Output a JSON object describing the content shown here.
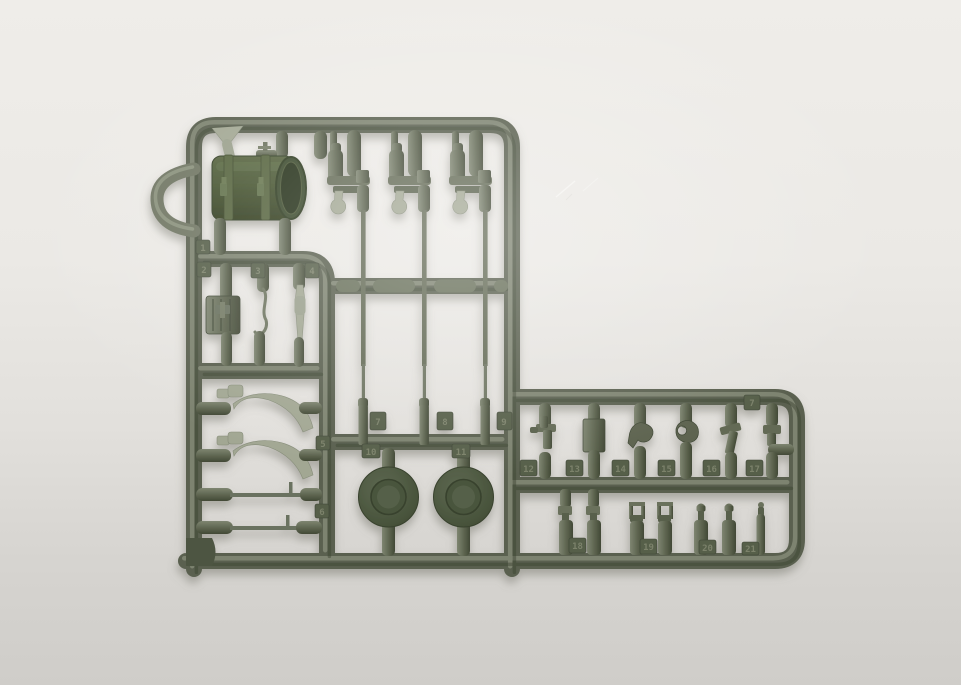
{
  "photo": {
    "subject": "Olive-green injection-molded plastic model kit sprue (parts runner) photographed on a neutral light-gray background",
    "shape": "L-shaped runner frame with a right-hand extension",
    "background_top": "#EFEDE9",
    "background_bottom": "#CFCDC9",
    "plastic_base": "#5A6150",
    "plastic_highlight": "#8B927D",
    "plastic_shadow": "#39402F",
    "drum_green": "#45532F",
    "light_part_tone": "#A2A793",
    "scratch_marks": "faint scratches on backdrop upper right"
  },
  "tags": {
    "t1": "1",
    "t2": "2",
    "t3": "3",
    "t4": "4",
    "t5": "5",
    "t6": "6",
    "t7": "7",
    "t8": "8",
    "t9": "9",
    "t10": "10",
    "t11": "11",
    "ext_corner": "7",
    "t12": "12",
    "t13": "13",
    "t14": "14",
    "t15": "15",
    "t16": "16",
    "t17": "17",
    "t18": "18",
    "t19": "19",
    "t20": "20",
    "t21": "21"
  },
  "parts_inventory": [
    {
      "name": "fuel drum with strap bands",
      "count": 1
    },
    {
      "name": "y-shaped bracket",
      "count": 1
    },
    {
      "name": "filler cap fitting",
      "count": 1
    },
    {
      "name": "stowage box",
      "count": 1
    },
    {
      "name": "tow hook wire",
      "count": 1
    },
    {
      "name": "slender barrel part",
      "count": 1
    },
    {
      "name": "curved fender brace",
      "count": 2
    },
    {
      "name": "long tie rod",
      "count": 2
    },
    {
      "name": "long rod assembly with bracket and teardrop fitting",
      "count": 3
    },
    {
      "name": "round wheel disc",
      "count": 2
    },
    {
      "name": "small bracket and hook fittings (extension top row)",
      "count": 6
    },
    {
      "name": "suspension link",
      "count": 2
    },
    {
      "name": "tow clevis fork",
      "count": 2
    },
    {
      "name": "knob bolt",
      "count": 2
    },
    {
      "name": "small pin fitting",
      "count": 1
    }
  ]
}
